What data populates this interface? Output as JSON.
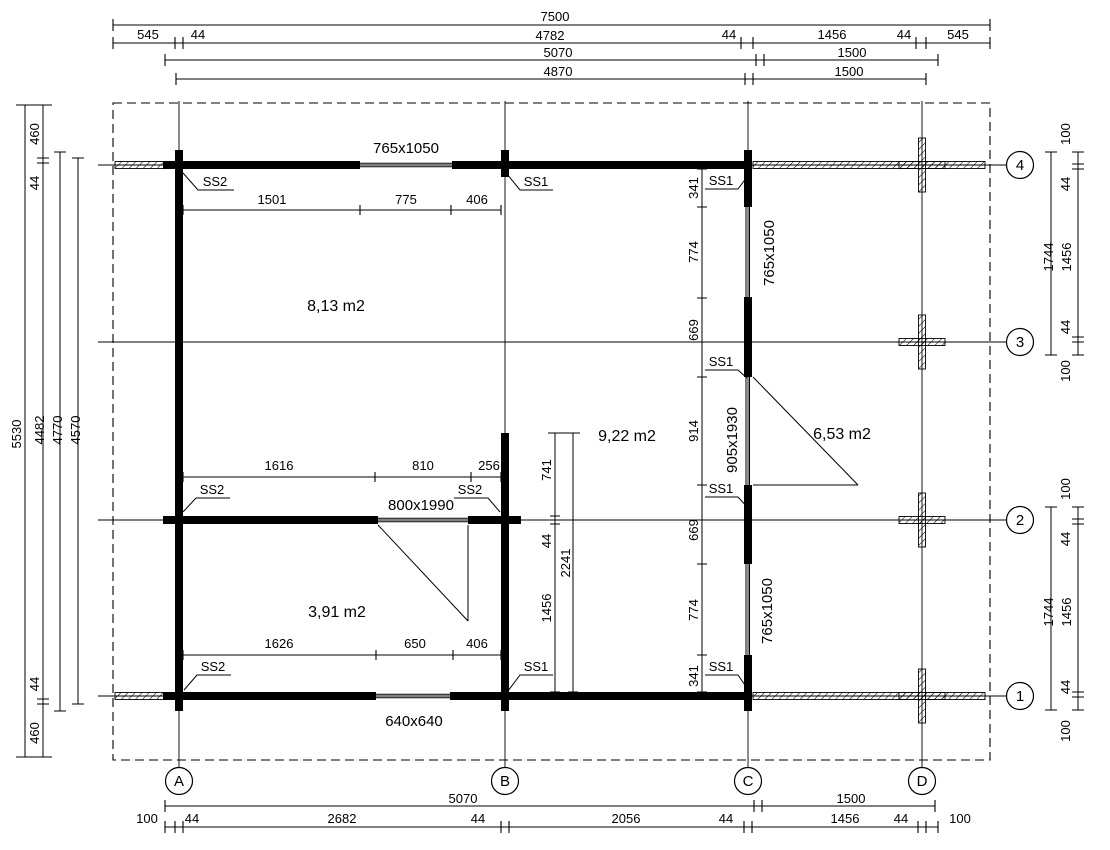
{
  "grid": {
    "columns": [
      "A",
      "B",
      "C",
      "D"
    ],
    "rows": [
      "4",
      "3",
      "2",
      "1"
    ]
  },
  "rooms": [
    {
      "area": "8,13 m2"
    },
    {
      "area": "9,22 m2"
    },
    {
      "area": "6,53 m2"
    },
    {
      "area": "3,91 m2"
    }
  ],
  "openings": {
    "top_window": "765x1050",
    "c_wall_upper_window": "765x1050",
    "c_wall_door": "905x1930",
    "c_wall_lower_window": "765x1050",
    "interior_door": "800x1990",
    "bottom_window": "640x640"
  },
  "markers": {
    "m1": "SS2",
    "m2": "SS1",
    "m3": "SS1",
    "m4": "SS1",
    "m5": "SS1",
    "m6": "SS1",
    "m7": "SS2",
    "m8": "SS2",
    "m9": "SS2",
    "m10": "SS1"
  },
  "dims": {
    "top": {
      "total": "7500",
      "chain": [
        "545",
        "44",
        "4782",
        "44",
        "1456",
        "44",
        "545"
      ],
      "row3": [
        "5070",
        "1500"
      ],
      "row4": [
        "4870",
        "1500"
      ]
    },
    "bottom": {
      "row1": [
        "5070",
        "1500"
      ],
      "chain": [
        "100",
        "44",
        "2682",
        "44",
        "2056",
        "44",
        "1456",
        "44",
        "100"
      ]
    },
    "left": {
      "totals": [
        "5530",
        "4482",
        "4770",
        "4570"
      ],
      "edge": [
        "460",
        "44",
        "44",
        "460"
      ]
    },
    "right_upper": [
      "100",
      "44",
      "1744",
      "1456",
      "44",
      "100"
    ],
    "right_lower": [
      "100",
      "44",
      "1744",
      "1456",
      "44",
      "100"
    ],
    "room_top": [
      "1501",
      "775",
      "406"
    ],
    "wall2_north": [
      "1616",
      "810",
      "256"
    ],
    "room_bottom": [
      "1626",
      "650",
      "406"
    ],
    "c_wall_chain": [
      "341",
      "774",
      "669",
      "914",
      "669",
      "774",
      "341"
    ],
    "b_wall_chain": [
      "741",
      "44",
      "1456",
      "2241"
    ]
  },
  "colors": {
    "line": "#000000",
    "background": "#ffffff"
  }
}
